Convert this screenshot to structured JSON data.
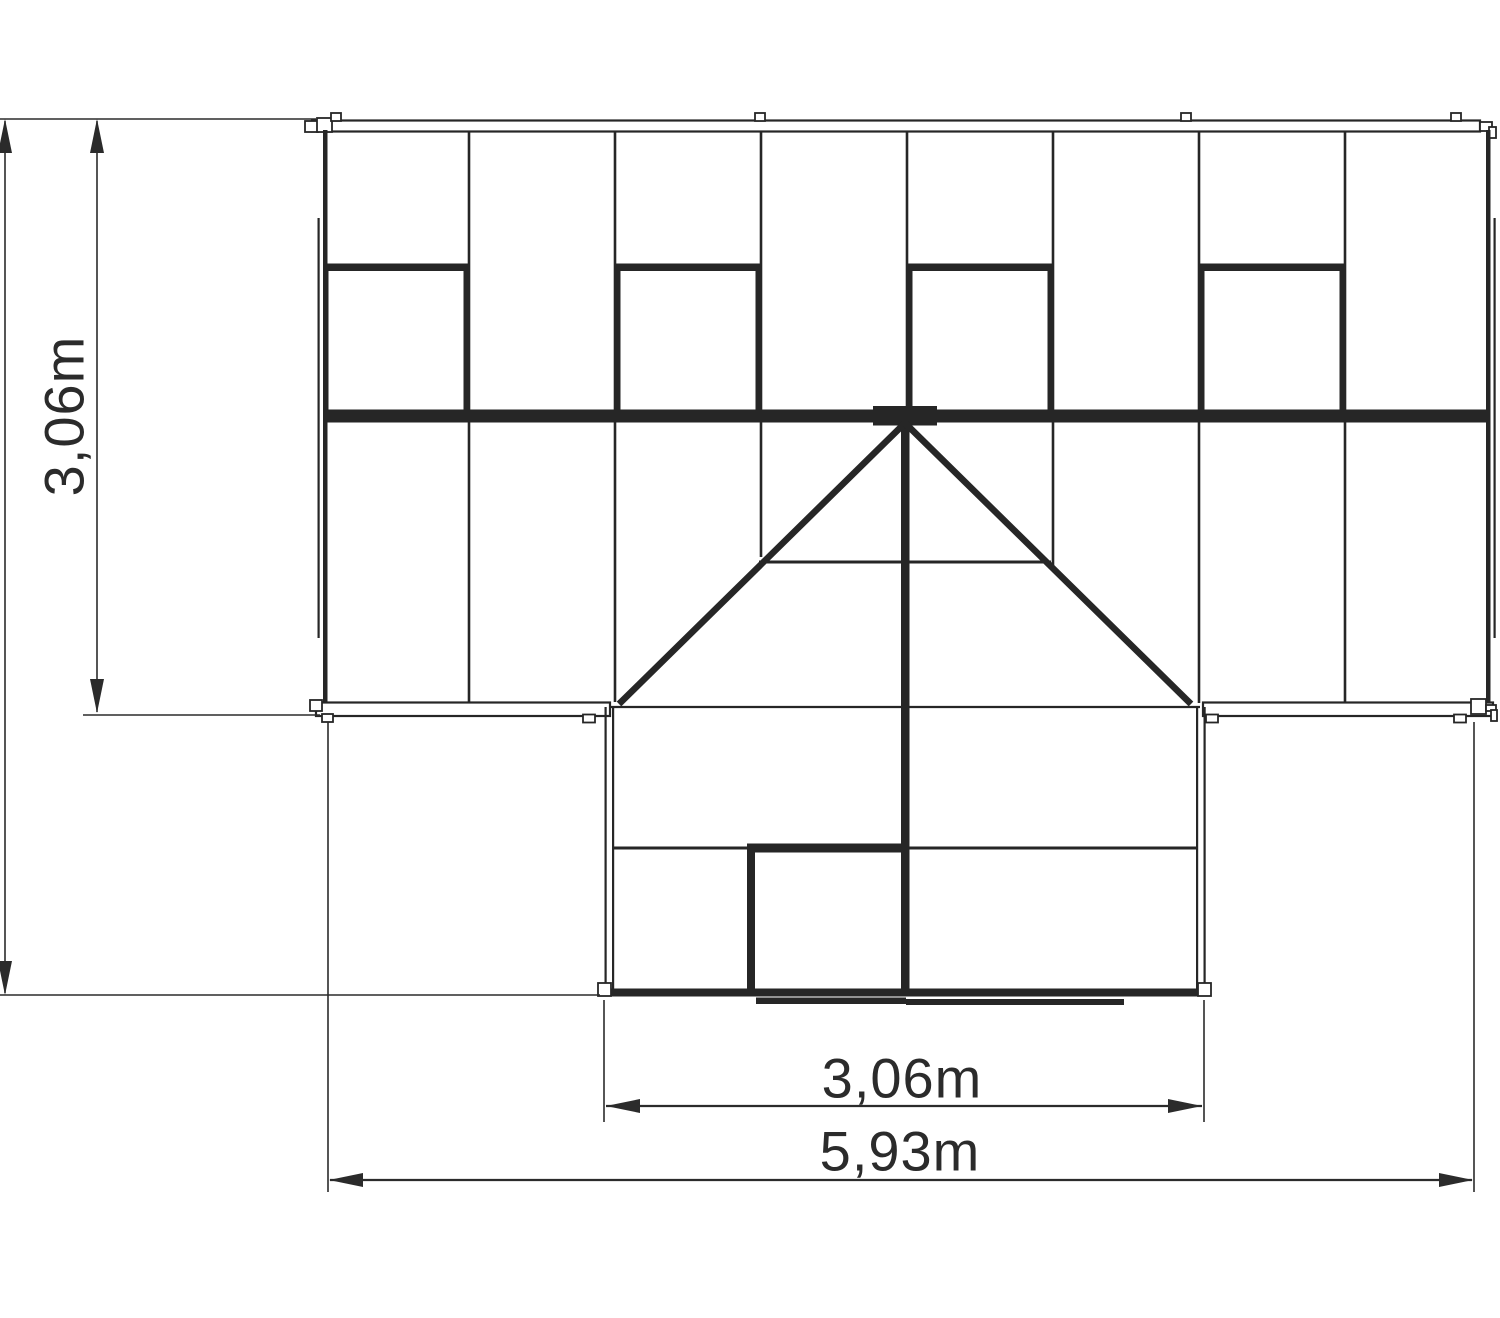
{
  "title": "Greenhouse T-shape top view plan",
  "colors": {
    "line": "#262626",
    "dim": "#2b2b2b",
    "white": "#ffffff",
    "bg": "#ffffff"
  },
  "dim_labels": {
    "side_depth": "3,06m",
    "porch_width": "3,06m",
    "total_width": "5,93m"
  },
  "drawing": {
    "rects": [
      {
        "x": 312,
        "y": 120.5,
        "w": 1168,
        "h": 11,
        "f": "w",
        "s": 2.2,
        "n": "top-eave-bar"
      },
      {
        "x": 305,
        "y": 121,
        "w": 13,
        "h": 11,
        "f": "w",
        "s": 1.8,
        "n": "top-eave-left-clip"
      },
      {
        "x": 317,
        "y": 118,
        "w": 15,
        "h": 14,
        "f": "w",
        "s": 1.8,
        "n": "top-eave-left-clip"
      },
      {
        "x": 331,
        "y": 113,
        "w": 10,
        "h": 8,
        "f": "w",
        "s": 1.8,
        "n": "top-eave-tab"
      },
      {
        "x": 755,
        "y": 113,
        "w": 10,
        "h": 8,
        "f": "w",
        "s": 1.8,
        "n": "top-eave-tab"
      },
      {
        "x": 1181,
        "y": 113,
        "w": 10,
        "h": 8,
        "f": "w",
        "s": 1.8,
        "n": "top-eave-tab"
      },
      {
        "x": 1451,
        "y": 113,
        "w": 10,
        "h": 8,
        "f": "w",
        "s": 1.8,
        "n": "top-eave-tab"
      },
      {
        "x": 1480,
        "y": 122,
        "w": 12,
        "h": 9,
        "f": "w",
        "s": 1.8,
        "n": "top-eave-right-hook"
      },
      {
        "x": 1489,
        "y": 127,
        "w": 7,
        "h": 11,
        "f": "w",
        "s": 1.8,
        "n": "top-eave-right-hook"
      },
      {
        "x": 323,
        "y": 130,
        "w": 4.5,
        "h": 582,
        "f": "l",
        "s": 0,
        "n": "main-left-edge"
      },
      {
        "x": 1486,
        "y": 130,
        "w": 4.5,
        "h": 582,
        "f": "l",
        "s": 0,
        "n": "main-right-edge"
      },
      {
        "x": 317.5,
        "y": 218,
        "w": 2.2,
        "h": 420,
        "f": "l",
        "s": 0,
        "n": "left-gutter-line"
      },
      {
        "x": 1493.5,
        "y": 218,
        "w": 2.2,
        "h": 420,
        "f": "l",
        "s": 0,
        "n": "right-gutter-line"
      },
      {
        "x": 467.7,
        "y": 132,
        "w": 2.6,
        "h": 278,
        "f": "l",
        "s": 0,
        "n": "roof-mullion"
      },
      {
        "x": 613.7,
        "y": 132,
        "w": 2.6,
        "h": 278,
        "f": "l",
        "s": 0,
        "n": "roof-mullion"
      },
      {
        "x": 759.7,
        "y": 132,
        "w": 2.6,
        "h": 278,
        "f": "l",
        "s": 0,
        "n": "roof-mullion"
      },
      {
        "x": 905.7,
        "y": 132,
        "w": 2.6,
        "h": 278,
        "f": "l",
        "s": 0,
        "n": "roof-mullion"
      },
      {
        "x": 1051.7,
        "y": 132,
        "w": 2.6,
        "h": 278,
        "f": "l",
        "s": 0,
        "n": "roof-mullion"
      },
      {
        "x": 1197.7,
        "y": 132,
        "w": 2.6,
        "h": 278,
        "f": "l",
        "s": 0,
        "n": "roof-mullion"
      },
      {
        "x": 1343.7,
        "y": 132,
        "w": 2.6,
        "h": 278,
        "f": "l",
        "s": 0,
        "n": "roof-mullion"
      },
      {
        "x": 323,
        "y": 263.5,
        "w": 146,
        "h": 7.5,
        "f": "l",
        "s": 0,
        "n": "roof-window-top"
      },
      {
        "x": 323.5,
        "y": 263.5,
        "w": 5,
        "h": 146.5,
        "f": "l",
        "s": 0,
        "n": "roof-window-side"
      },
      {
        "x": 463.5,
        "y": 263.5,
        "w": 5,
        "h": 146.5,
        "f": "l",
        "s": 0,
        "n": "roof-window-side"
      },
      {
        "x": 615,
        "y": 263.5,
        "w": 146,
        "h": 7.5,
        "f": "l",
        "s": 0,
        "n": "roof-window-top"
      },
      {
        "x": 615.5,
        "y": 263.5,
        "w": 5,
        "h": 146.5,
        "f": "l",
        "s": 0,
        "n": "roof-window-side"
      },
      {
        "x": 755.5,
        "y": 263.5,
        "w": 5,
        "h": 146.5,
        "f": "l",
        "s": 0,
        "n": "roof-window-side"
      },
      {
        "x": 907,
        "y": 263.5,
        "w": 146,
        "h": 7.5,
        "f": "l",
        "s": 0,
        "n": "roof-window-top"
      },
      {
        "x": 907.5,
        "y": 263.5,
        "w": 5,
        "h": 146.5,
        "f": "l",
        "s": 0,
        "n": "roof-window-side"
      },
      {
        "x": 1047.5,
        "y": 263.5,
        "w": 5,
        "h": 146.5,
        "f": "l",
        "s": 0,
        "n": "roof-window-side"
      },
      {
        "x": 1199,
        "y": 263.5,
        "w": 146,
        "h": 7.5,
        "f": "l",
        "s": 0,
        "n": "roof-window-top"
      },
      {
        "x": 1199.5,
        "y": 263.5,
        "w": 5,
        "h": 146.5,
        "f": "l",
        "s": 0,
        "n": "roof-window-side"
      },
      {
        "x": 1339.5,
        "y": 263.5,
        "w": 5,
        "h": 146.5,
        "f": "l",
        "s": 0,
        "n": "roof-window-side"
      },
      {
        "x": 323,
        "y": 409.5,
        "w": 1167,
        "h": 13,
        "f": "l",
        "s": 0,
        "n": "ridge-beam"
      },
      {
        "x": 873,
        "y": 406,
        "w": 64,
        "h": 19.5,
        "f": "l",
        "s": 0,
        "n": "ridge-apex-plate"
      },
      {
        "x": 467.7,
        "y": 422,
        "w": 2.6,
        "h": 281,
        "f": "l",
        "s": 0,
        "n": "front-slope-mullion"
      },
      {
        "x": 613.7,
        "y": 422,
        "w": 2.6,
        "h": 280,
        "f": "l",
        "s": 0,
        "n": "front-slope-mullion"
      },
      {
        "x": 759.7,
        "y": 422,
        "w": 2.6,
        "h": 135,
        "f": "l",
        "s": 0,
        "n": "front-slope-mullion"
      },
      {
        "x": 1051.7,
        "y": 422,
        "w": 2.6,
        "h": 147,
        "f": "l",
        "s": 0,
        "n": "front-slope-mullion"
      },
      {
        "x": 1197.7,
        "y": 422,
        "w": 2.6,
        "h": 281,
        "f": "l",
        "s": 0,
        "n": "front-slope-mullion"
      },
      {
        "x": 1343.7,
        "y": 422,
        "w": 2.6,
        "h": 281,
        "f": "l",
        "s": 0,
        "n": "front-slope-mullion"
      },
      {
        "x": 901,
        "y": 420,
        "w": 8.5,
        "h": 576,
        "f": "l",
        "s": 0,
        "n": "porch-ridge-beam"
      },
      {
        "x": 316,
        "y": 702.5,
        "w": 294,
        "h": 13.5,
        "f": "w",
        "s": 2.2,
        "n": "left-eave-bar"
      },
      {
        "x": 1203,
        "y": 702.5,
        "w": 290,
        "h": 13.5,
        "f": "w",
        "s": 2.2,
        "n": "right-eave-bar"
      },
      {
        "x": 310,
        "y": 700,
        "w": 12,
        "h": 11,
        "f": "w",
        "s": 1.8,
        "n": "eave-clip"
      },
      {
        "x": 322,
        "y": 714,
        "w": 11,
        "h": 8,
        "f": "w",
        "s": 1.8,
        "n": "eave-tab"
      },
      {
        "x": 583,
        "y": 714.5,
        "w": 12,
        "h": 8,
        "f": "w",
        "s": 1.8,
        "n": "eave-tab"
      },
      {
        "x": 1206,
        "y": 714.5,
        "w": 12,
        "h": 8,
        "f": "w",
        "s": 1.8,
        "n": "eave-tab"
      },
      {
        "x": 1454,
        "y": 714.5,
        "w": 12,
        "h": 8,
        "f": "w",
        "s": 1.8,
        "n": "eave-tab"
      },
      {
        "x": 1471,
        "y": 699,
        "w": 15,
        "h": 15,
        "f": "w",
        "s": 1.8,
        "n": "eave-right-clip"
      },
      {
        "x": 1486,
        "y": 705,
        "w": 10,
        "h": 6,
        "f": "w",
        "s": 1.8,
        "n": "eave-right-hook"
      },
      {
        "x": 1491,
        "y": 710,
        "w": 6,
        "h": 11,
        "f": "w",
        "s": 1.8,
        "n": "eave-right-hook"
      },
      {
        "x": 604.5,
        "y": 707,
        "w": 2.2,
        "h": 289,
        "f": "l",
        "s": 0,
        "n": "porch-left-wall"
      },
      {
        "x": 612,
        "y": 707,
        "w": 2.2,
        "h": 289,
        "f": "l",
        "s": 0,
        "n": "porch-left-wall-inner"
      },
      {
        "x": 1196,
        "y": 707,
        "w": 2.2,
        "h": 289,
        "f": "l",
        "s": 0,
        "n": "porch-right-wall-inner"
      },
      {
        "x": 1203.5,
        "y": 707,
        "w": 2.2,
        "h": 289,
        "f": "l",
        "s": 0,
        "n": "porch-right-wall"
      },
      {
        "x": 747,
        "y": 843.5,
        "w": 162,
        "h": 9,
        "f": "l",
        "s": 0,
        "n": "door-top-bar"
      },
      {
        "x": 747,
        "y": 843.5,
        "w": 8,
        "h": 153,
        "f": "l",
        "s": 0,
        "n": "door-left-frame"
      },
      {
        "x": 604,
        "y": 988.5,
        "w": 601,
        "h": 8,
        "f": "l",
        "s": 0,
        "n": "porch-bottom-bar"
      },
      {
        "x": 598,
        "y": 983,
        "w": 13,
        "h": 13,
        "f": "w",
        "s": 1.8,
        "n": "porch-corner-clip"
      },
      {
        "x": 1198,
        "y": 983,
        "w": 13,
        "h": 13,
        "f": "w",
        "s": 1.8,
        "n": "porch-corner-clip"
      },
      {
        "x": 756,
        "y": 997.5,
        "w": 150,
        "h": 6.5,
        "f": "l",
        "s": 0,
        "n": "door-threshold"
      },
      {
        "x": 906,
        "y": 999,
        "w": 218,
        "h": 6,
        "f": "l",
        "s": 0,
        "n": "door-threshold"
      }
    ],
    "lines": [
      {
        "x1": 905,
        "y1": 423,
        "x2": 619,
        "y2": 704,
        "w": 6.5,
        "c": "l",
        "n": "valley-diagonal-left"
      },
      {
        "x1": 905,
        "y1": 423,
        "x2": 1191,
        "y2": 704,
        "w": 6.5,
        "c": "l",
        "n": "valley-diagonal-right"
      },
      {
        "x1": 759,
        "y1": 562,
        "x2": 1051,
        "y2": 562,
        "w": 3,
        "c": "l",
        "n": "porch-roof-crossbar"
      },
      {
        "x1": 610,
        "y1": 707,
        "x2": 1200,
        "y2": 707,
        "w": 2.2,
        "c": "l",
        "n": "main-eave-line"
      },
      {
        "x1": 613,
        "y1": 848,
        "x2": 1196,
        "y2": 848,
        "w": 3,
        "c": "l",
        "n": "porch-wall-crossbar"
      },
      {
        "x1": 0,
        "y1": 119,
        "x2": 316,
        "y2": 119,
        "w": 1.6,
        "c": "d",
        "n": "extension-line-top"
      },
      {
        "x1": 0,
        "y1": 995,
        "x2": 600,
        "y2": 995,
        "w": 1.6,
        "c": "d",
        "n": "extension-line-bottom"
      },
      {
        "x1": 5,
        "y1": 121,
        "x2": 5,
        "y2": 993,
        "w": 1.6,
        "c": "d",
        "n": "dim-line-total-depth"
      },
      {
        "x1": 97,
        "y1": 121,
        "x2": 97,
        "y2": 712,
        "w": 1.6,
        "c": "d",
        "n": "dim-line-side-depth"
      },
      {
        "x1": 83,
        "y1": 715,
        "x2": 320,
        "y2": 715,
        "w": 1.6,
        "c": "d",
        "n": "extension-line-eave"
      },
      {
        "x1": 604,
        "y1": 1000,
        "x2": 604,
        "y2": 1122,
        "w": 1.6,
        "c": "d",
        "n": "extension-line-porch-left"
      },
      {
        "x1": 1204,
        "y1": 1000,
        "x2": 1204,
        "y2": 1122,
        "w": 1.6,
        "c": "d",
        "n": "extension-line-porch-right"
      },
      {
        "x1": 606,
        "y1": 1106,
        "x2": 1202,
        "y2": 1106,
        "w": 2.2,
        "c": "d",
        "n": "dim-line-porch-width"
      },
      {
        "x1": 328,
        "y1": 722,
        "x2": 328,
        "y2": 1192,
        "w": 1.6,
        "c": "d",
        "n": "extension-line-total-left"
      },
      {
        "x1": 1474,
        "y1": 722,
        "x2": 1474,
        "y2": 1192,
        "w": 1.6,
        "c": "d",
        "n": "extension-line-total-right"
      },
      {
        "x1": 330,
        "y1": 1180,
        "x2": 1472,
        "y2": 1180,
        "w": 2.2,
        "c": "d",
        "n": "dim-line-total-width"
      }
    ],
    "polys": [
      {
        "pts": "5,119 -2,153 12,153",
        "n": "arrowhead-up"
      },
      {
        "pts": "5,995 -2,961 12,961",
        "n": "arrowhead-down"
      },
      {
        "pts": "97,119 90,153 104,153",
        "n": "arrowhead-up"
      },
      {
        "pts": "97,713 90,679 104,679",
        "n": "arrowhead-down"
      },
      {
        "pts": "606,1106 640,1099 640,1113",
        "n": "arrowhead-left"
      },
      {
        "pts": "1202,1106 1168,1099 1168,1113",
        "n": "arrowhead-right"
      },
      {
        "pts": "329,1180 363,1173 363,1187",
        "n": "arrowhead-left"
      },
      {
        "pts": "1473,1180 1439,1173 1439,1187",
        "n": "arrowhead-right"
      }
    ]
  }
}
